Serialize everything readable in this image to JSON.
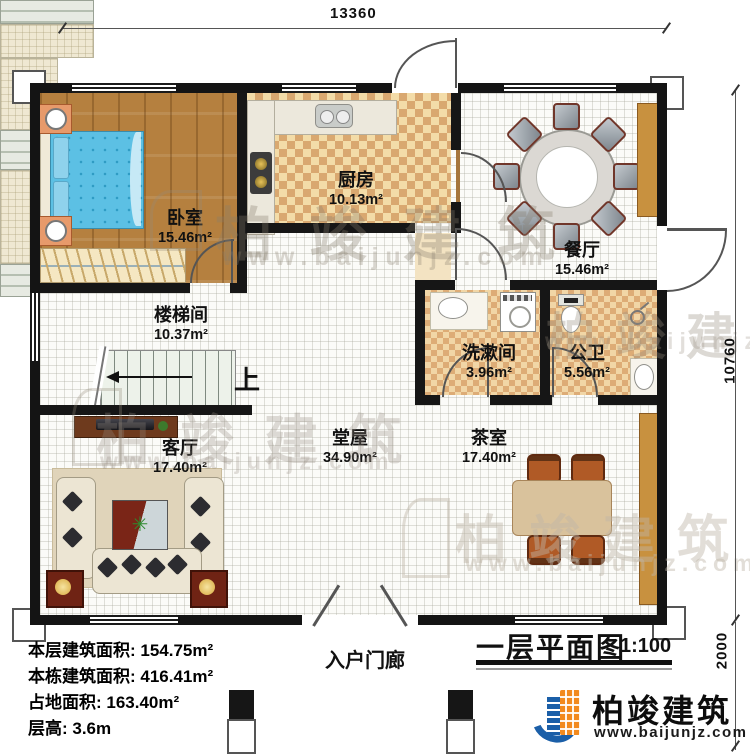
{
  "plan": {
    "title": "一层平面图",
    "scale": "1:100",
    "up_label": "上"
  },
  "dimensions": {
    "top_width": "13360",
    "right_height": "10760",
    "porch_depth": "2000"
  },
  "rooms": [
    {
      "name": "卧室",
      "area": "15.46m²"
    },
    {
      "name": "厨房",
      "area": "10.13m²"
    },
    {
      "name": "餐厅",
      "area": "15.46m²"
    },
    {
      "name": "楼梯间",
      "area": "10.37m²"
    },
    {
      "name": "洗漱间",
      "area": "3.96m²"
    },
    {
      "name": "公卫",
      "area": "5.56m²"
    },
    {
      "name": "客厅",
      "area": "17.40m²"
    },
    {
      "name": "堂屋",
      "area": "34.90m²"
    },
    {
      "name": "茶室",
      "area": "17.40m²"
    },
    {
      "name": "入户门廊",
      "area": ""
    }
  ],
  "info_lines": [
    "本层建筑面积: 154.75m²",
    "本栋建筑面积: 416.41m²",
    "占地面积: 163.40m²",
    "层高: 3.6m"
  ],
  "brand": {
    "name": "柏竣建筑",
    "website": "www.baijunjz.com"
  },
  "colors": {
    "wall": "#161616",
    "wood_floor": "#b5803f",
    "tile_light": "#f3dca8",
    "tile_dark": "#d9a870",
    "bed": "#5cc0e4",
    "logo_blue": "#1b5fa8",
    "logo_orange": "#f28a1e"
  }
}
